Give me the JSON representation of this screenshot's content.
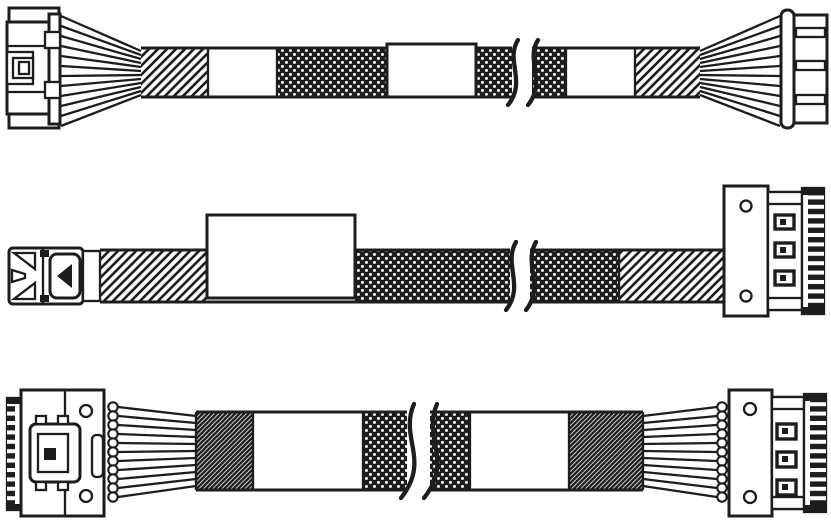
{
  "diagram": {
    "background_color": "#ffffff",
    "line_color": "#1d1d1b",
    "cables": [
      {
        "name": "cable-1",
        "left_connector": "crimp-housing-connector-with-latch",
        "right_connector": "boxed-header-connector",
        "label_text": "",
        "segments": [
          "wire-fan",
          "diagonal-hatch-sleeve",
          "plain-jacket",
          "braided-mesh-sleeve",
          "blank-label",
          "braided-mesh-sleeve",
          "break-mark",
          "braided-mesh-sleeve",
          "plain-jacket",
          "diagonal-hatch-sleeve",
          "wire-fan"
        ]
      },
      {
        "name": "cable-2",
        "left_connector": "low-profile-plug-with-pull-tab",
        "right_connector": "edge-connector-with-screw-holes",
        "label_text": "",
        "segments": [
          "diagonal-hatch-sleeve",
          "blank-label",
          "braided-mesh-sleeve",
          "break-mark",
          "braided-mesh-sleeve",
          "diagonal-hatch-sleeve"
        ]
      },
      {
        "name": "cable-3",
        "left_connector": "vertical-board-connector-with-latch-and-screw-holes",
        "right_connector": "edge-connector-with-screw-holes",
        "label_text": "",
        "segments": [
          "round-wire-bundle",
          "ribbon-fan",
          "dense-woven-sleeve",
          "plain-jacket",
          "braided-mesh-sleeve",
          "break-mark",
          "braided-mesh-sleeve",
          "plain-jacket",
          "dense-woven-sleeve",
          "ribbon-fan",
          "round-wire-bundle"
        ]
      }
    ]
  }
}
